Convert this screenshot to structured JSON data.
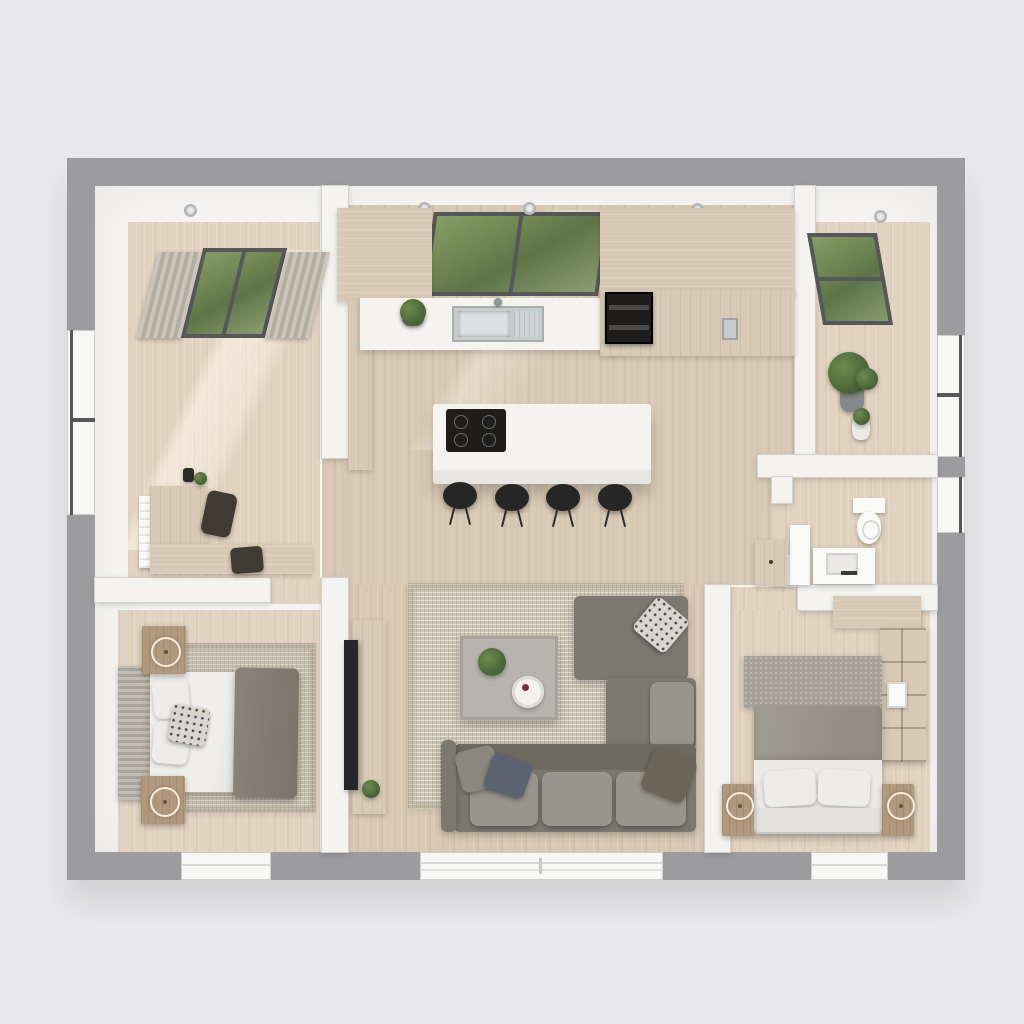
{
  "scene": {
    "kind": "3d-floor-plan-top-down-render",
    "style": "photorealistic architectural visualization, no visible text or UI chrome",
    "layout": "two-bedroom apartment with open-plan kitchen, dining and living area"
  },
  "palette": {
    "bg": "#e9e9eb",
    "wallOuter": "#9c9c9e",
    "wallInner": "#f6f5f3",
    "wallBar": "#f4f3f0",
    "wallEdge": "#d2d1cf",
    "floorWood": "#e2d3c0",
    "floorWoodDark": "#d9c9b4",
    "counterWhite": "#f4f3f0",
    "cabinetWood": "#d8cab6",
    "cabinetWoodDark": "#c9b9a2",
    "applianceBlack": "#1e1d1c",
    "steel": "#c9cccd",
    "sofa": "#7b7870",
    "sofaLight": "#98958c",
    "sofaDark": "#6c695f",
    "rugLiving": "#cdc6b5",
    "rugBedroom": "#c7bfae",
    "bedWhite": "#edece8",
    "throwGrey": "#8b847a",
    "duvetGrey": "#a39e93",
    "headboardPanel": "#a5a199",
    "nightstandWood": "#b1997d",
    "glassGreen": "#71854f",
    "frameDark": "#55575a",
    "curtain": "#ccc5bb",
    "curtainDark": "#b3aca1",
    "plantGreen": "#4c683a",
    "plantDark": "#36502a",
    "potGrey": "#8f9192",
    "white": "#fafaf9",
    "chairDark": "#413a32",
    "tvBlack": "#26272a",
    "ringCream": "#f4ecdc",
    "tableGrey": "#b7b4ad"
  },
  "rooms": [
    {
      "id": "entry-office",
      "position": "top-left",
      "features": [
        "curtained-garden-window",
        "left-wall-window",
        "l-shaped-desk",
        "desk-chair",
        "side-chair",
        "wall-radiator",
        "desk-plant",
        "ceiling-spotlight"
      ]
    },
    {
      "id": "kitchen-dining",
      "position": "top-center",
      "features": [
        "garden-window-over-sink",
        "corner-upper-cabinets",
        "white-countertop",
        "double-basin-sink",
        "faucet",
        "counter-plant",
        "built-in-double-oven",
        "tall-cabinets-with-fridge",
        "white-island",
        "induction-cooktop",
        "four-black-bar-stools",
        "ceiling-spotlights"
      ]
    },
    {
      "id": "utility-entry",
      "position": "top-right",
      "features": [
        "skylight-garden-window",
        "right-wall-window",
        "large-potted-plant",
        "small-potted-plant"
      ]
    },
    {
      "id": "bathroom",
      "position": "right-middle",
      "features": [
        "right-wall-window",
        "wall-hung-toilet",
        "vanity-with-basin",
        "tall-white-cabinet",
        "hall-cabinet"
      ]
    },
    {
      "id": "bedroom-1",
      "position": "bottom-left",
      "features": [
        "double-bed-head-left",
        "ribbed-headboard",
        "white-duvet",
        "grey-throw",
        "patterned-accent-pillow",
        "two-white-pillows",
        "two-wood-nightstands",
        "two-table-lamps",
        "area-rug",
        "bottom-wall-window"
      ]
    },
    {
      "id": "living-room",
      "position": "bottom-center",
      "features": [
        "l-shaped-grey-sectional-sofa",
        "chaise-with-patterned-cushion",
        "three-throw-pillows",
        "woven-area-rug",
        "square-coffee-table",
        "table-plant",
        "round-tray",
        "media-console",
        "flat-tv-panel",
        "console-plant",
        "large-bottom-window"
      ]
    },
    {
      "id": "bedroom-2",
      "position": "bottom-right",
      "features": [
        "double-bed-head-bottom",
        "fabric-headboard-panel",
        "grey-duvet",
        "two-white-pillows",
        "footboard-bench",
        "two-nightstands-with-lamps",
        "open-shelf-unit",
        "overhead-wardrobe-cabinet",
        "bottom-wall-window"
      ]
    }
  ],
  "counts": {
    "bar_stools": 4,
    "ceiling_spotlights": 5,
    "table_lamps": 4,
    "potted_plants": 6,
    "exterior_windows": 9
  }
}
